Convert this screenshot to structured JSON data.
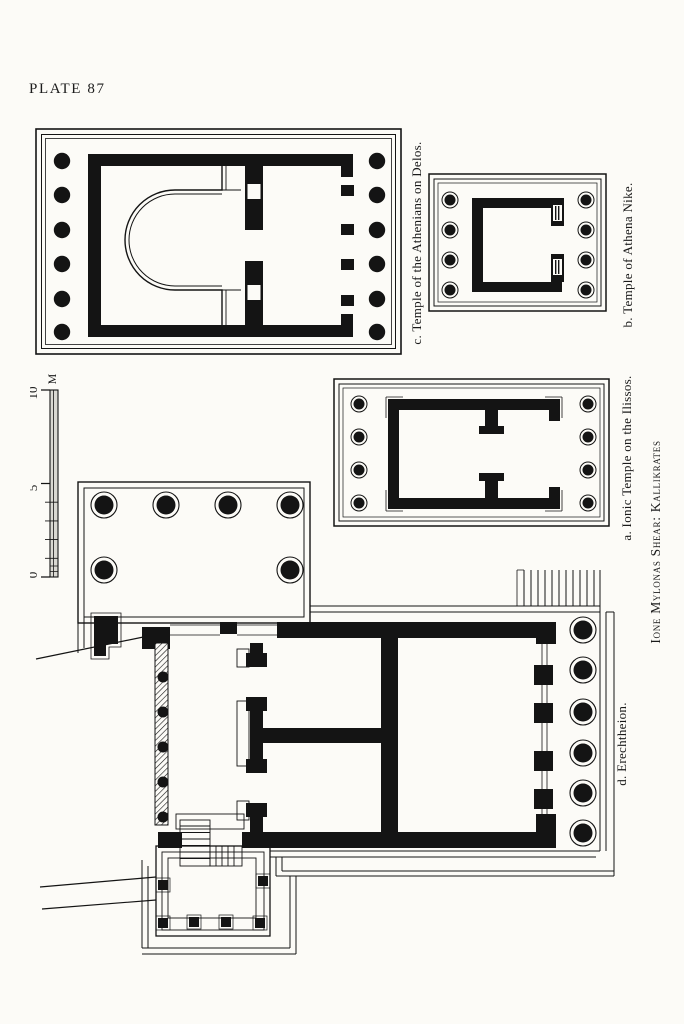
{
  "page": {
    "plate_label": "PLATE 87"
  },
  "plans": {
    "c": {
      "caption": "c.  Temple of the Athenians on Delos."
    },
    "b": {
      "caption": "b.  Temple of Athena Nike."
    },
    "a": {
      "caption": "a.  Ionic Temple on the Ilissos."
    },
    "d": {
      "caption": "d.  Erechtheion."
    }
  },
  "credit": "Ione Mylonas Shear: Kallikrates",
  "scale_bar": {
    "tick_0": "0",
    "tick_5": "5",
    "tick_10": "10",
    "unit": "M"
  },
  "colors": {
    "paper": "#fcfbf7",
    "ink": "#141414"
  }
}
